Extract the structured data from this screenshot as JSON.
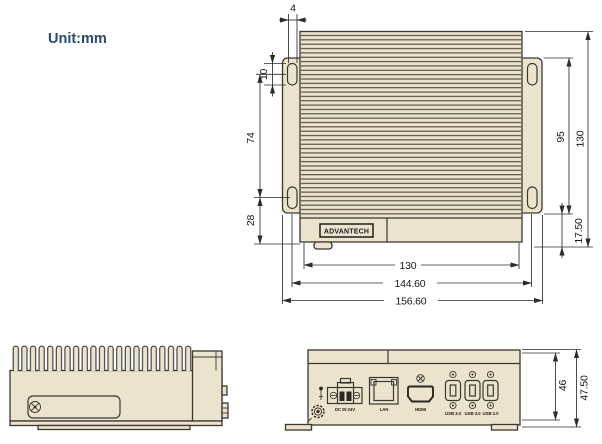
{
  "unit_label": "Unit:mm",
  "logo_text": "ADVANTECH",
  "colors": {
    "body_fill": "#ece3ce",
    "outline": "#3a372f",
    "dimension": "#2c2c2c",
    "unit_text": "#2b4a6b"
  },
  "top_view": {
    "dims": {
      "top_offset": "4",
      "slot_len": "10",
      "left_upper": "74",
      "left_lower": "28",
      "right_inner": "95",
      "right_outer": "130",
      "right_bottom": "17.50",
      "bottom_inner": "130",
      "bottom_mid": "144.60",
      "bottom_outer": "156.60"
    }
  },
  "front_view": {
    "dims": {
      "inner": "46",
      "outer": "47.50"
    },
    "ports": [
      {
        "id": "dc-in",
        "label": "DC IN 24V"
      },
      {
        "id": "lan",
        "label": "LAN"
      },
      {
        "id": "hdmi",
        "label": "HDMI"
      },
      {
        "id": "usb-1",
        "label": "USB 3.0"
      },
      {
        "id": "usb-2",
        "label": "USB 3.0"
      },
      {
        "id": "usb-3",
        "label": "USB 2.0"
      }
    ]
  }
}
